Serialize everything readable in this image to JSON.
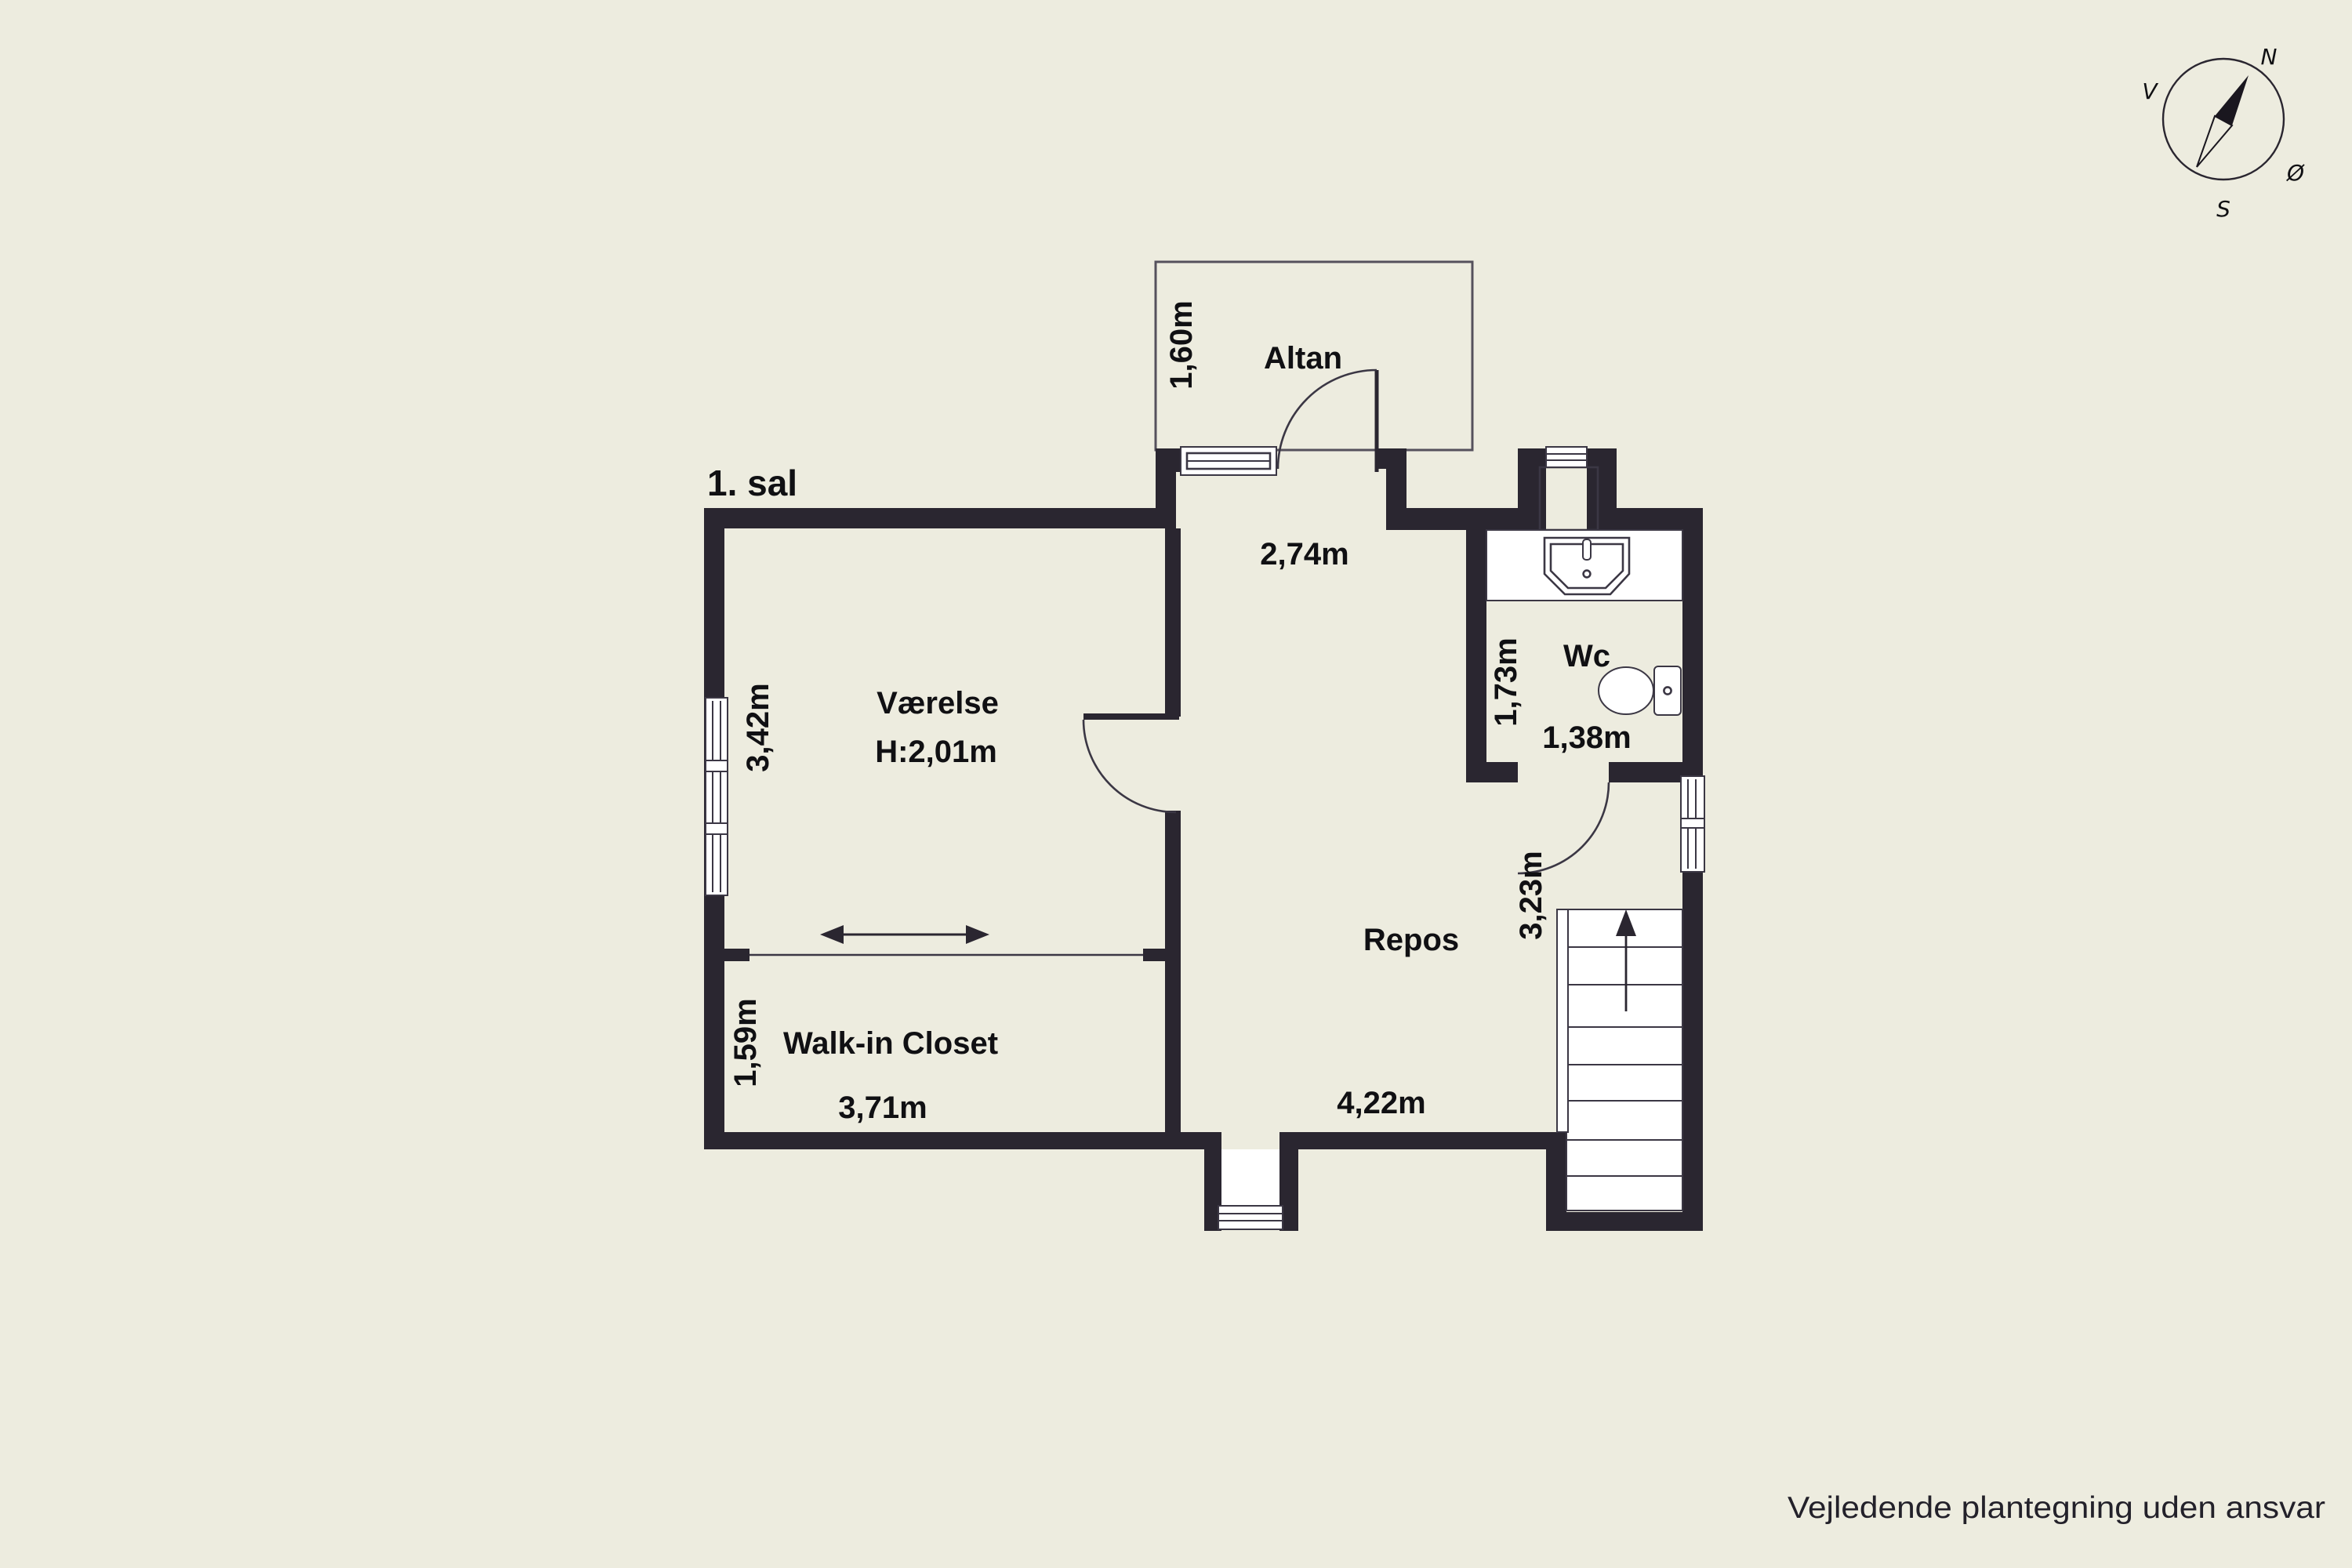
{
  "page": {
    "title": "1. sal",
    "footer": "Vejledende plantegning uden ansvar"
  },
  "rooms": {
    "vaerelse": {
      "label": "Værelse",
      "ceiling_height": "H:2,01m",
      "side_label": "3,42m"
    },
    "walk_in_closet": {
      "label": "Walk-in Closet",
      "width_label": "3,71m",
      "side_label": "1,59m"
    },
    "repos": {
      "label": "Repos",
      "north_label": "2,74m",
      "south_label": "4,22m",
      "stair_label": "3,23m"
    },
    "wc": {
      "label": "Wc",
      "side_label": "1,73m",
      "width_label": "1,38m"
    },
    "altan": {
      "label": "Altan",
      "side_label": "1,60m"
    }
  },
  "compass": {
    "north": "N",
    "east": "Ø",
    "south": "S",
    "west": "V"
  },
  "colors": {
    "background": "#EDECDF",
    "wall": "#2A2630",
    "fixture_fill": "#FFFFFF",
    "outline": "#3B3744",
    "text": "#101013"
  }
}
